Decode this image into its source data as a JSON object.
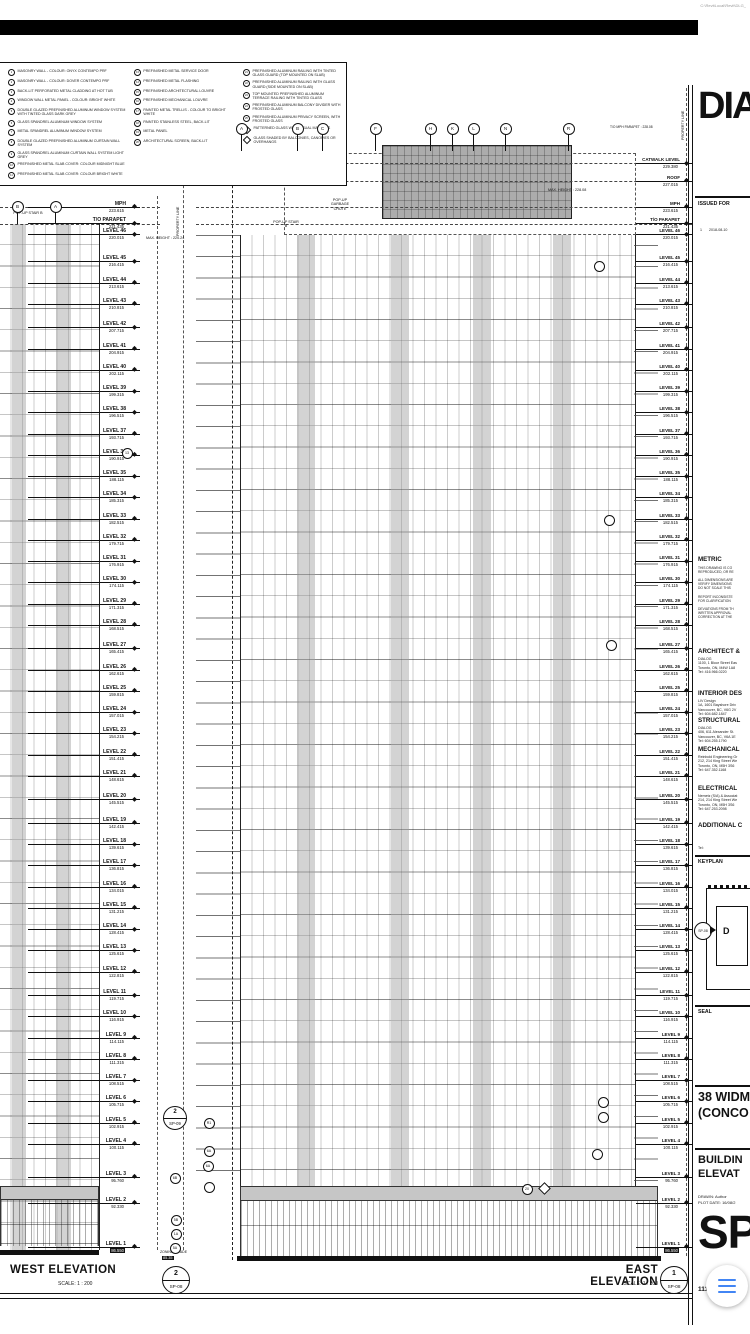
{
  "paths": {
    "top": "C:\\RevitLocal\\Revit\\DLG_",
    "bottom": "C:\\RevitLocal\\Revit\\DLG_"
  },
  "fab": {
    "icon": "hamburger-menu",
    "color": "#4285F4"
  },
  "legend": {
    "col1": [
      {
        "id": "1",
        "text": "MASONRY WALL - COLOUR: ONYX CONTEMPO PRF"
      },
      {
        "id": "2",
        "text": "MASONRY WALL - COLOUR: DOVER CONTEMPO PRF"
      },
      {
        "id": "3",
        "text": "BACK-LIT PERFORATED METAL CLADDING AT HOT TUB"
      },
      {
        "id": "4",
        "text": "WINDOW WALL METAL PANEL - COLOUR: BRIGHT WHITE"
      },
      {
        "id": "5",
        "text": "DOUBLE GLAZED PREFINISHED ALUMINUM WINDOW SYSTEM WITH TINTED GLASS DARK GREY"
      },
      {
        "id": "6",
        "text": "GLASS SPANDREL ALUMINUM WINDOW SYSTEM"
      },
      {
        "id": "7",
        "text": "METAL SPANDREL ALUMINUM WINDOW SYSTEM"
      },
      {
        "id": "8",
        "text": "DOUBLE GLAZED PREFINISHED ALUMINUM CURTAIN WALL SYSTEM"
      },
      {
        "id": "9",
        "text": "GLASS SPANDREL ALUMINUM CURTAIN WALL SYSTEM LIGHT GREY"
      },
      {
        "id": "10",
        "text": "PREFINISHED METAL SLAB COVER: COLOUR MIDNIGHT BLUE"
      },
      {
        "id": "11",
        "text": "PREFINISHED METAL SLAB COVER: COLOUR BRIGHT WHITE"
      },
      {
        "id": "12",
        "text": "OVERHEAD GARAGE DOOR"
      }
    ],
    "col2": [
      {
        "id": "13",
        "text": "PREFINISHED METAL SERVICE DOOR"
      },
      {
        "id": "14",
        "text": "PREFINISHED METAL FLASHING"
      },
      {
        "id": "15",
        "text": "PREFINISHED ARCHITECTURAL LOUVRE"
      },
      {
        "id": "16",
        "text": "PREFINISHED MECHANICAL LOUVRE"
      },
      {
        "id": "17",
        "text": "PAINTED METAL TRELLIS - COLOUR TO BRIGHT WHITE"
      },
      {
        "id": "18",
        "text": "PAINTED STAINLESS STEEL, BACK-LIT"
      },
      {
        "id": "19",
        "text": "METAL PANEL"
      },
      {
        "id": "20",
        "text": "ARCHITECTURAL SCREEN, BACK-LIT"
      }
    ],
    "col3_circles": [
      {
        "id": "21",
        "text": "PREFINISHED ALUMINUM RAILING WITH TINTED GLASS GUARD (TOP MOUNTED ON SLAB)"
      },
      {
        "id": "22",
        "text": "PREFINISHED ALUMINUM RAILING WITH GLASS GUARD (SIDE MOUNTED ON SLAB)"
      },
      {
        "id": "23",
        "text": "TOP MOUNTED PREFINISHED ALUMINUM TERRACE RAILING WITH TINTED GLASS"
      },
      {
        "id": "24",
        "text": "PREFINISHED ALUMINUM BALCONY DIVIDER WITH FROSTED GLASS"
      },
      {
        "id": "25",
        "text": "PREFINISHED ALUMINUM PRIVACY SCREEN, WITH FROSTED GLASS"
      }
    ],
    "col3_diamonds": [
      {
        "text": "PATTERNED GLASS WITH VISUAL MARKERS"
      },
      {
        "text": "GLASS SHADED BY BALCONIES, CANOPIES OR OVERHANGS"
      }
    ]
  },
  "levels": [
    {
      "label": "CATWALK LEVEL",
      "value": "229.380",
      "scope": "east"
    },
    {
      "label": "ROOF",
      "value": "227.015",
      "scope": "east"
    },
    {
      "label": "MPH",
      "value": "223.615",
      "scope": "both"
    },
    {
      "label": "T/O PARAPET",
      "value": "221.435",
      "scope": "both"
    },
    {
      "label": "LEVEL 46",
      "value": "220.015",
      "scope": "both"
    },
    {
      "label": "LEVEL 45",
      "value": "216.415",
      "scope": "both"
    },
    {
      "label": "LEVEL 44",
      "value": "213.615",
      "scope": "both"
    },
    {
      "label": "LEVEL 43",
      "value": "210.815",
      "scope": "both"
    },
    {
      "label": "LEVEL 42",
      "value": "207.715",
      "scope": "both"
    },
    {
      "label": "LEVEL 41",
      "value": "204.915",
      "scope": "both"
    },
    {
      "label": "LEVEL 40",
      "value": "202.115",
      "scope": "both"
    },
    {
      "label": "LEVEL 39",
      "value": "199.315",
      "scope": "both"
    },
    {
      "label": "LEVEL 38",
      "value": "196.515",
      "scope": "both"
    },
    {
      "label": "LEVEL 37",
      "value": "193.715",
      "scope": "both"
    },
    {
      "label": "LEVEL 36",
      "value": "190.915",
      "scope": "both"
    },
    {
      "label": "LEVEL 35",
      "value": "188.115",
      "scope": "both"
    },
    {
      "label": "LEVEL 34",
      "value": "185.315",
      "scope": "both"
    },
    {
      "label": "LEVEL 33",
      "value": "182.515",
      "scope": "both"
    },
    {
      "label": "LEVEL 32",
      "value": "179.715",
      "scope": "both"
    },
    {
      "label": "LEVEL 31",
      "value": "176.915",
      "scope": "both"
    },
    {
      "label": "LEVEL 30",
      "value": "174.115",
      "scope": "both"
    },
    {
      "label": "LEVEL 29",
      "value": "171.315",
      "scope": "both"
    },
    {
      "label": "LEVEL 28",
      "value": "168.515",
      "scope": "both"
    },
    {
      "label": "LEVEL 27",
      "value": "165.415",
      "scope": "both"
    },
    {
      "label": "LEVEL 26",
      "value": "162.615",
      "scope": "both"
    },
    {
      "label": "LEVEL 25",
      "value": "159.815",
      "scope": "both"
    },
    {
      "label": "LEVEL 24",
      "value": "157.015",
      "scope": "both"
    },
    {
      "label": "LEVEL 23",
      "value": "154.215",
      "scope": "both"
    },
    {
      "label": "LEVEL 22",
      "value": "151.415",
      "scope": "both"
    },
    {
      "label": "LEVEL 21",
      "value": "148.615",
      "scope": "both"
    },
    {
      "label": "LEVEL 20",
      "value": "145.515",
      "scope": "both"
    },
    {
      "label": "LEVEL 19",
      "value": "142.415",
      "scope": "both"
    },
    {
      "label": "LEVEL 18",
      "value": "139.615",
      "scope": "both"
    },
    {
      "label": "LEVEL 17",
      "value": "136.815",
      "scope": "both"
    },
    {
      "label": "LEVEL 16",
      "value": "134.015",
      "scope": "both"
    },
    {
      "label": "LEVEL 15",
      "value": "131.215",
      "scope": "both"
    },
    {
      "label": "LEVEL 14",
      "value": "128.415",
      "scope": "both"
    },
    {
      "label": "LEVEL 13",
      "value": "125.615",
      "scope": "both"
    },
    {
      "label": "LEVEL 12",
      "value": "122.815",
      "scope": "both"
    },
    {
      "label": "LEVEL 11",
      "value": "119.715",
      "scope": "both"
    },
    {
      "label": "LEVEL 10",
      "value": "116.915",
      "scope": "both"
    },
    {
      "label": "LEVEL 9",
      "value": "114.115",
      "scope": "both"
    },
    {
      "label": "LEVEL 8",
      "value": "111.315",
      "scope": "both"
    },
    {
      "label": "LEVEL 7",
      "value": "108.515",
      "scope": "both"
    },
    {
      "label": "LEVEL 6",
      "value": "105.715",
      "scope": "both"
    },
    {
      "label": "LEVEL 5",
      "value": "102.915",
      "scope": "both"
    },
    {
      "label": "LEVEL 4",
      "value": "100.115",
      "scope": "both"
    },
    {
      "label": "LEVEL 3",
      "value": "95.760",
      "scope": "both"
    },
    {
      "label": "LEVEL 2",
      "value": "92.330",
      "scope": "both"
    },
    {
      "label": "LEVEL 1",
      "value": "86.550",
      "scope": "both",
      "boxed": true
    }
  ],
  "grids": {
    "west": [
      {
        "label": "B",
        "x": 17
      },
      {
        "label": "A",
        "x": 55
      }
    ],
    "east": [
      {
        "label": "A",
        "x": 241
      },
      {
        "label": "B",
        "x": 297
      },
      {
        "label": "C",
        "x": 322
      },
      {
        "label": "F",
        "x": 375
      },
      {
        "label": "H",
        "x": 430
      },
      {
        "label": "K",
        "x": 452
      },
      {
        "label": "L",
        "x": 473
      },
      {
        "label": "N",
        "x": 505
      },
      {
        "label": "R",
        "x": 568
      }
    ]
  },
  "keynotes": [
    {
      "label": "13",
      "x": 126,
      "y": 452
    },
    {
      "label": "R1",
      "x": 208,
      "y": 1122
    },
    {
      "label": "6A",
      "x": 208,
      "y": 1150
    },
    {
      "label": "6A",
      "x": 207,
      "y": 1165
    },
    {
      "label": "6B",
      "x": 174,
      "y": 1177
    },
    {
      "label": "",
      "x": 208,
      "y": 1186
    },
    {
      "label": "5B",
      "x": 175,
      "y": 1219
    },
    {
      "label": "1A",
      "x": 175,
      "y": 1233
    },
    {
      "label": "5A",
      "x": 174,
      "y": 1247
    },
    {
      "label": "20",
      "x": 526,
      "y": 1188
    },
    {
      "label": "",
      "x": 602,
      "y": 1101
    },
    {
      "label": "",
      "x": 602,
      "y": 1116
    },
    {
      "label": "",
      "x": 596,
      "y": 1153
    },
    {
      "label": "",
      "x": 598,
      "y": 265
    },
    {
      "label": "",
      "x": 608,
      "y": 519
    },
    {
      "label": "",
      "x": 610,
      "y": 644
    }
  ],
  "detail_callout": {
    "num": "2",
    "sheet": "SP-09"
  },
  "annotations": {
    "property_line": "PROPERTY LINE",
    "max_height_west": "MAX. HEIGHT : 220.24",
    "max_height_east": "MAX. HEIGHT : 228.08",
    "mph_parapet_dim": "T/O MPH PARAPET : 228.08",
    "popup_stair": "POP-UP STAIR B",
    "popup_garbage": "POP-UP GARBAGE CHUTE",
    "zoning_grade": "ZONING GRADE",
    "zoning_value": "85.35"
  },
  "titles": {
    "west": {
      "title": "WEST ELEVATION",
      "scale": "SCALE:  1 : 200",
      "num": "2",
      "sheet": "SP-08"
    },
    "east": {
      "title": "EAST ELEVATION",
      "scale": "SCALE:  1 : 200",
      "num": "1",
      "sheet": "SP-08"
    }
  },
  "titleblock": {
    "logo": "DIA",
    "issued_for": "ISSUED FOR",
    "rev_no": "1",
    "rev_date": "2018-08-10",
    "metric_header": "METRIC",
    "metric_lines": [
      "THIS DRAWING IS CO",
      "REPRODUCED, OR RE",
      "",
      "ALL DIMENSIONS ARE",
      "VERIFY DIMENSIONS",
      "DO NOT SCALE THIS",
      "",
      "REPORT INCONSISTE",
      "FOR CLARIFICATION",
      "",
      "DEVIATIONS FROM TH",
      "WRITTEN APPROVAL",
      "CORRECTION AT THE"
    ],
    "architect": {
      "header": "ARCHITECT &",
      "l1": "DIALOG",
      "l2": "1100, 1 Bloor Street Eas",
      "l3": "Toronto, ON, M4W 1A8",
      "l4": "Tel:  416.966.0220"
    },
    "interior": {
      "header": "INTERIOR DES",
      "l1": "LIV Design",
      "l2": "1A, 1601 Bayshore Driv",
      "l3": "Vancouver, BC, V6G 2V",
      "l4": "Tel:  604.682.1847"
    },
    "structural": {
      "header": "STRUCTURAL",
      "l1": "DIALOG",
      "l2": "406, 611 Alexander St.",
      "l3": "Vancouver, BC, V6A 1E",
      "l4": "Tel:  604.255.1790"
    },
    "mechanical": {
      "header": "MECHANICAL",
      "l1": "Reinbold Engineering Gr",
      "l2": "212, 214 King Street We",
      "l3": "Toronto, ON, M5H 3S6",
      "l4": "Tel:  647.352.1168"
    },
    "electrical": {
      "header": "ELECTRICAL",
      "l1": "Nemetz (S/A) & Associat",
      "l2": "214, 214 King Street We",
      "l3": "Toronto, ON, M5H 3S6",
      "l4": "Tel:  647.253.2098"
    },
    "additional": {
      "header": "ADDITIONAL C",
      "tel": "Tel:"
    },
    "keyplan_label": "KEYPLAN",
    "keyplan_letter": "D",
    "keyplan_callout": "SP-08",
    "seal_label": "SEAL",
    "project_l1": "38 WIDM",
    "project_l2": "(CONCO",
    "sheet_title_l1": "BUILDIN",
    "sheet_title_l2": "ELEVAT",
    "drawn": "DRAWN:  Author",
    "plot": "PLOT DATE: 16/08/2",
    "sheet_big": "SP",
    "project_no": "111291"
  }
}
